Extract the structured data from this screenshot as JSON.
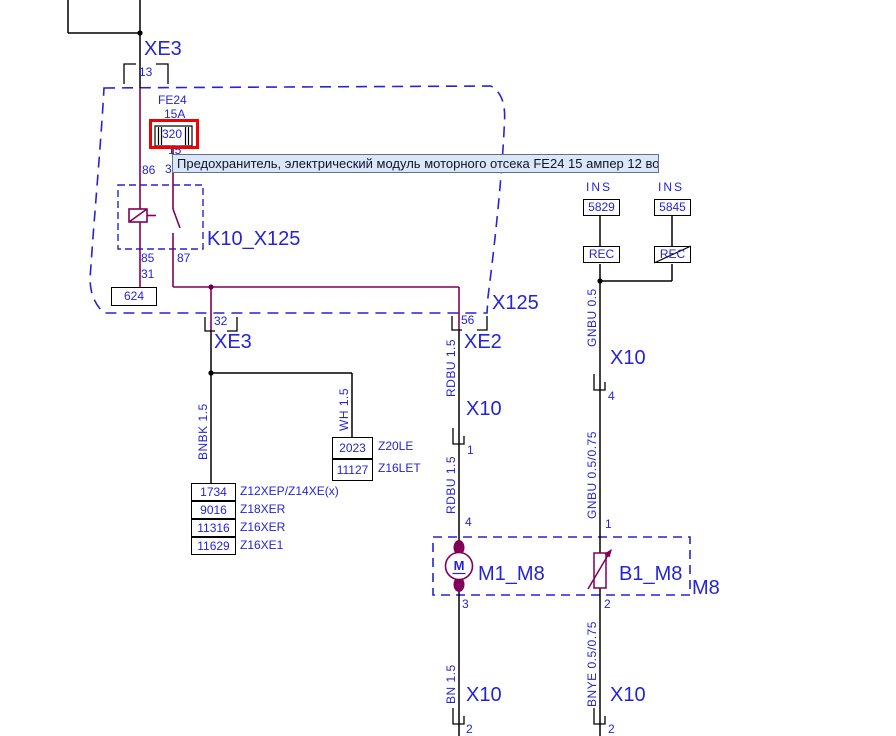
{
  "colors": {
    "label_blue": "#2424d6",
    "wire_purple": "#80005a",
    "highlight_red": "#f00000",
    "tooltip_bg": "#dbe7f6",
    "wire_black": "#000000"
  },
  "tooltip": "Предохранитель, электрический модуль моторного отсека FE24 15 ампер 12 вольт при...",
  "power_connector": {
    "label": "XE3",
    "pin": "13"
  },
  "fuse": {
    "id": "FE24",
    "rating": "15A",
    "track": "320",
    "pin": "15"
  },
  "relay": {
    "label": "K10_X125",
    "pin_86": "86",
    "pin_30": "30",
    "pin_85": "85",
    "pin_87": "87"
  },
  "ground": {
    "pin": "31",
    "track": "624"
  },
  "module_label": "X125",
  "ins_left": {
    "caption": "INS",
    "track": "5829",
    "box": "REC"
  },
  "ins_right": {
    "caption": "INS",
    "track": "5845",
    "box": "REC"
  },
  "xe3_branch": {
    "pin": "32",
    "connector": "XE3",
    "wire": "BNBK 1.5"
  },
  "xe2_branch": {
    "pin": "56",
    "connector": "XE2",
    "wire_upper": "RDBU 1.5",
    "x10": "X10",
    "pin_x10": "1",
    "wire_lower": "RDBU 1.5",
    "pin_motor_top": "4"
  },
  "wh_branch": {
    "wire": "WH 1.5",
    "tracks": [
      {
        "num": "2023",
        "engine": "Z20LE"
      },
      {
        "num": "11127",
        "engine": "Z16LET"
      }
    ]
  },
  "bnbk_tracks": [
    {
      "num": "1734",
      "engine": "Z12XEP/Z14XE(x)"
    },
    {
      "num": "9016",
      "engine": "Z18XER"
    },
    {
      "num": "11316",
      "engine": "Z16XER"
    },
    {
      "num": "11629",
      "engine": "Z16XE1"
    }
  ],
  "gnbu_branch": {
    "wire_upper": "GNBU 0.5",
    "x10": "X10",
    "pin_x10": "4",
    "wire_lower": "GNBU 0.5/0.75",
    "pin_top": "1"
  },
  "m8": {
    "label": "M8",
    "motor": {
      "label": "M1_M8",
      "symbol": "M",
      "pin_top": "4",
      "pin_bottom": "3"
    },
    "sensor": {
      "label": "B1_M8",
      "pin_top": "1",
      "pin_bottom": "2"
    }
  },
  "bottom_left": {
    "wire": "BN 1.5",
    "x10": "X10",
    "pin": "2"
  },
  "bottom_right": {
    "wire": "BNYE 0.5/0.75",
    "x10": "X10",
    "pin": "2"
  }
}
